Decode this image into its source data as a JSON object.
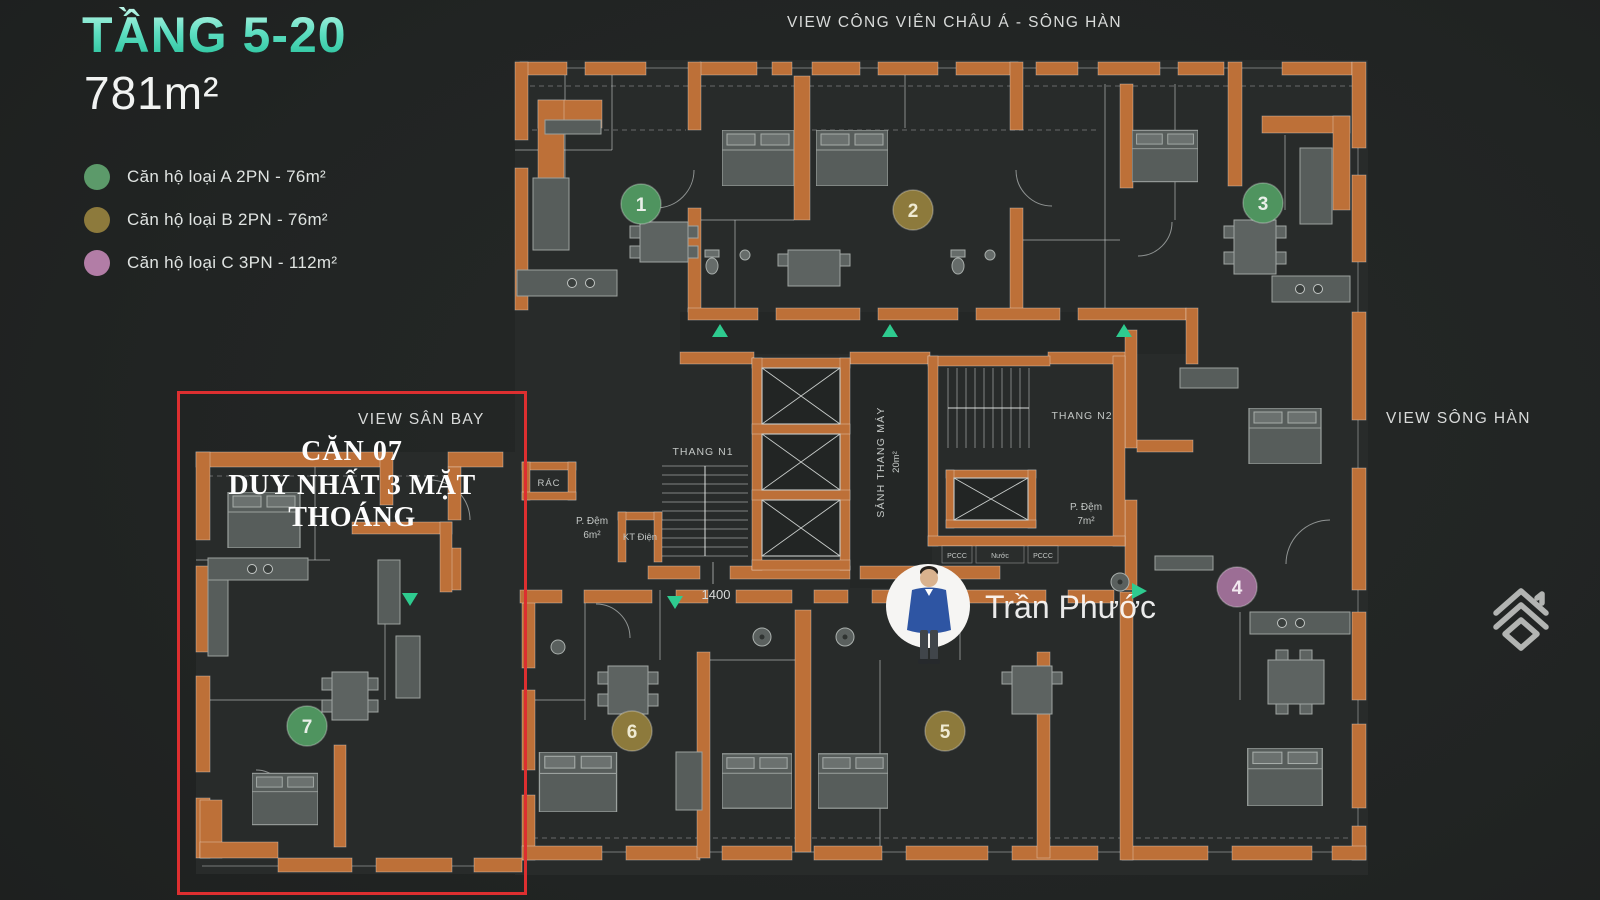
{
  "header": {
    "floor_range": "TẦNG 5-20",
    "area": "781m²"
  },
  "legend": {
    "items": [
      {
        "label": "Căn hộ loại A 2PN - 76m²",
        "color": "#5c9a6a"
      },
      {
        "label": "Căn hộ loại B 2PN - 76m²",
        "color": "#8d7a3c"
      },
      {
        "label": "Căn hộ loại C 3PN - 112m²",
        "color": "#b27da6"
      }
    ]
  },
  "views": {
    "top": "VIEW CÔNG VIÊN CHÂU Á - SÔNG HÀN",
    "right": "VIEW SÔNG HÀN",
    "airport": "VIEW SÂN BAY"
  },
  "highlight": {
    "title": "CĂN 07",
    "subtitle": "DUY NHẤT 3 MẶT THOÁNG"
  },
  "agent": {
    "name": "Trần Phước"
  },
  "plan": {
    "units": [
      {
        "number": "1",
        "color": "#4f945f"
      },
      {
        "number": "2",
        "color": "#8d7a3c"
      },
      {
        "number": "3",
        "color": "#4f945f"
      },
      {
        "number": "4",
        "color": "#9c6e95"
      },
      {
        "number": "5",
        "color": "#8d7a3c"
      },
      {
        "number": "6",
        "color": "#8d7a3c"
      },
      {
        "number": "7",
        "color": "#4f945f"
      }
    ],
    "labels": {
      "stair1": "THANG N1",
      "stair2": "THANG N2",
      "lobby": "SẢNH THANG MÁY",
      "lobby_area": "20m²",
      "buffer1_line1": "P. Đệm",
      "buffer1_line2": "6m²",
      "buffer2_line1": "P. Đệm",
      "buffer2_line2": "7m²",
      "electrical": "KT Điện",
      "trash": "RÁC",
      "dimension": "1400",
      "fire1": "PCCC",
      "water": "Nước",
      "fire2": "PCCC"
    }
  }
}
